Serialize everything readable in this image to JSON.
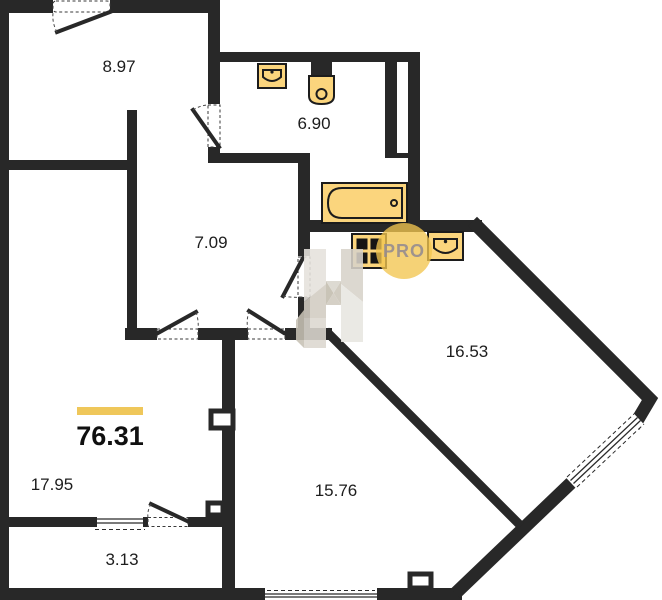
{
  "floorplan": {
    "total_area": {
      "value": "76.31"
    },
    "rooms": {
      "entry_hall": {
        "area": "8.97"
      },
      "bathroom": {
        "area": "6.90"
      },
      "corridor": {
        "area": "7.09"
      },
      "kitchen_living": {
        "area": "16.53"
      },
      "living_room": {
        "area": "17.95"
      },
      "bedroom": {
        "area": "15.76"
      },
      "balcony": {
        "area": "3.13"
      }
    },
    "watermark": {
      "label": "PRO"
    },
    "colors": {
      "wall": "#282828",
      "fixture_fill": "#fbd57d",
      "accent_bar": "#efc75a",
      "watermark_circle": "#f2c54f",
      "watermark_text": "#968d90"
    }
  }
}
